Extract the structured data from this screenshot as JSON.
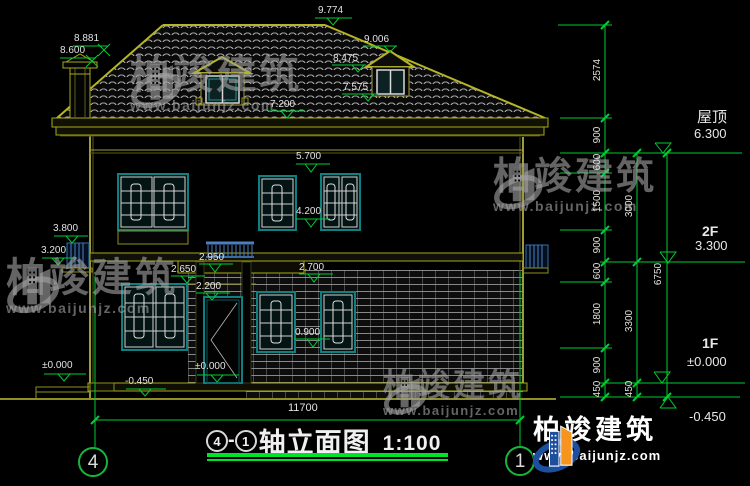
{
  "annotations": {
    "ridge": "9.774",
    "chimney_top": "8.881",
    "chimney_cap": "8.600",
    "dormer_apex": "9.006",
    "dormer_eave": "8.475",
    "dormer_sill": "7.575",
    "eave": "7.200",
    "w2_head": "5.700",
    "w2_sill": "4.200",
    "w1_head": "2.700",
    "w1_sill": "0.900",
    "balcony": "2.950",
    "porch": "2.650",
    "door_head": "2.200",
    "stair_head": "3.800",
    "stair_sill": "3.200",
    "entry_level": "±0.000",
    "ground_level": "-0.450",
    "door_level": "±0.000",
    "total_width": "11700"
  },
  "chain_inner": [
    "2574",
    "900",
    "600",
    "1500",
    "900",
    "600",
    "1800",
    "900",
    "450"
  ],
  "chain_mid": [
    "3000",
    "3300",
    "450"
  ],
  "chain_outer": [
    "6750"
  ],
  "floors": {
    "roof_name": "屋顶",
    "roof_elev": "6.300",
    "f2_name": "2F",
    "f2_elev": "3.300",
    "f1_name": "1F",
    "f1_elev": "±0.000",
    "ground_elev": "-0.450"
  },
  "titlebar": {
    "axis_a": "4",
    "sep": "-",
    "axis_b": "1",
    "name": "轴立面图",
    "scale": "1:100"
  },
  "bubbles": {
    "left": "4",
    "right": "1"
  },
  "brand": {
    "name": "柏竣建筑",
    "url": "www.baijunjz.com"
  },
  "colors": {
    "dim_green": "#00cc33",
    "line_olive": "#8f8f1e",
    "window_teal": "#0e8080",
    "railing_blue": "#4a7fc0",
    "logo_blue": "#1d4f9e",
    "logo_orange": "#f7941d"
  }
}
